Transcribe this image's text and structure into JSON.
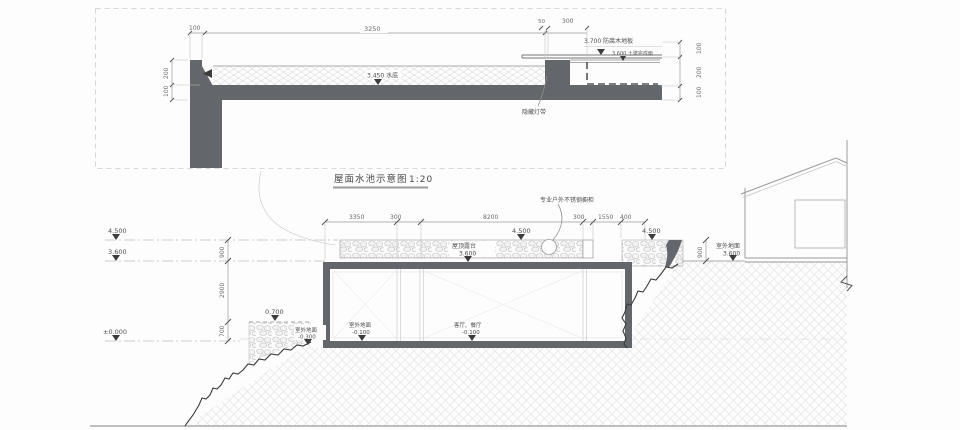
{
  "title": {
    "text": "屋面水池示意图",
    "scale": "1:20"
  },
  "detail": {
    "dim_100_top": "100",
    "dim_3250": "3250",
    "dim_50": "50",
    "dim_300": "300",
    "dim_200_left": "200",
    "dim_100_left": "100",
    "dim_100_r1": "100",
    "dim_200_r": "200",
    "dim_100_r2": "100",
    "lvl_deck": "3.700 防腐木地板",
    "lvl_finish": "3.600 土建完成面",
    "lvl_water": "3.450 水底",
    "note_light": "隐藏灯带"
  },
  "section": {
    "dims_top": [
      "3350",
      "300",
      "8200",
      "300",
      "1550",
      "400"
    ],
    "dim_900_left": "900",
    "dim_2900": "2900",
    "dim_700": "700",
    "dim_900_right": "900",
    "lvl_4500_left": "4.500",
    "lvl_3600_left": "3.600",
    "lvl_0000": "±0.000",
    "lvl_0700": "0.700",
    "lvl_4500_terrace": "4.500",
    "lvl_4500_right": "4.500",
    "terrace_name": "屋顶露台",
    "terrace_lvl": "3.600",
    "ground_right_name": "室外地面",
    "ground_right_lvl": "3.600",
    "ground_left_name": "室外地面",
    "ground_left_lvl": "-0.300",
    "indoor1_name": "室外地面",
    "indoor1_lvl": "-0.100",
    "indoor2_name": "客厅、餐厅",
    "indoor2_lvl": "-0.100",
    "note_cabinet": "专业户外不锈钢橱柜"
  }
}
